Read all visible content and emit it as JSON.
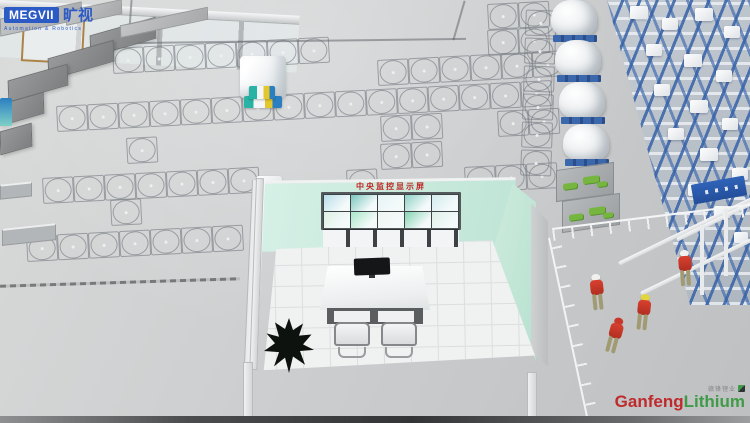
{
  "header": {
    "megvii_logo": "MEGVII",
    "megvii_cn": "旷视",
    "megvii_tagline": "Automation & Robotics"
  },
  "control_room": {
    "sign_text": "中央监控显示屏"
  },
  "footer": {
    "ganfeng_cn": "赣锋锂业",
    "ganfeng_red": "Ganfeng",
    "ganfeng_green": "Lithium"
  },
  "colors": {
    "accent_blue": "#2d5bc6",
    "rack_blue": "#3b67ad",
    "wall_mint": "#cdebdd",
    "sign_red": "#c42424",
    "ganfeng_red": "#bf2a2c",
    "ganfeng_green": "#3f9b47",
    "vest_red": "#d8402f",
    "helmet_yellow": "#e2d63c"
  },
  "scene": {
    "grid_rows": [
      {
        "x": 112,
        "y": 48,
        "n": 7
      },
      {
        "x": 487,
        "y": 4,
        "n": 2
      },
      {
        "x": 487,
        "y": 30,
        "n": 2
      },
      {
        "x": 377,
        "y": 60,
        "n": 6
      },
      {
        "x": 56,
        "y": 106,
        "n": 16
      },
      {
        "x": 380,
        "y": 116,
        "n": 2
      },
      {
        "x": 497,
        "y": 111,
        "n": 2
      },
      {
        "x": 380,
        "y": 144,
        "n": 2
      },
      {
        "x": 464,
        "y": 167,
        "n": 3
      },
      {
        "x": 126,
        "y": 138,
        "n": 1
      },
      {
        "x": 42,
        "y": 178,
        "n": 7
      },
      {
        "x": 110,
        "y": 200,
        "n": 1
      },
      {
        "x": 26,
        "y": 236,
        "n": 7
      },
      {
        "x": 346,
        "y": 170,
        "n": 1
      }
    ],
    "grid_col": {
      "x": 523,
      "y": 10,
      "n": 6
    },
    "dark_blocks": [
      {
        "x": 90,
        "y": 26,
        "w": 64,
        "h": 20
      },
      {
        "x": 48,
        "y": 49,
        "w": 64,
        "h": 20
      },
      {
        "x": 8,
        "y": 72,
        "w": 58,
        "h": 20
      },
      {
        "x": 0,
        "y": 98,
        "w": 42,
        "h": 20
      },
      {
        "x": 0,
        "y": 127,
        "w": 30,
        "h": 22
      }
    ],
    "machines": [
      {
        "x": 0,
        "y": 10,
        "w": 80,
        "h": 16
      },
      {
        "x": 66,
        "y": 5,
        "w": 54,
        "h": 13
      },
      {
        "x": 120,
        "y": 16,
        "w": 86,
        "h": 11
      }
    ],
    "left_platforms": [
      {
        "x": 0,
        "y": 183,
        "w": 30,
        "h": 12
      },
      {
        "x": 2,
        "y": 226,
        "w": 52,
        "h": 14
      }
    ],
    "bags": [
      {
        "x": 551,
        "y": 0
      },
      {
        "x": 555,
        "y": 40
      },
      {
        "x": 559,
        "y": 82
      },
      {
        "x": 563,
        "y": 124
      }
    ],
    "green_platforms": [
      {
        "x": 556,
        "y": 166
      },
      {
        "x": 562,
        "y": 197
      }
    ],
    "workers": [
      {
        "x": 589,
        "y": 274,
        "helmet": "#f0f0ee",
        "rot": -6
      },
      {
        "x": 635,
        "y": 294,
        "helmet": "#e2d63c",
        "rot": 6
      },
      {
        "x": 606,
        "y": 317,
        "helmet": "#c8372a",
        "rot": 15
      },
      {
        "x": 677,
        "y": 250,
        "helmet": "#f0f0ee",
        "rot": -4
      }
    ],
    "rack_boxes": [
      {
        "x": 630,
        "y": 6,
        "w": 18,
        "h": 13
      },
      {
        "x": 662,
        "y": 18,
        "w": 16,
        "h": 12
      },
      {
        "x": 695,
        "y": 8,
        "w": 18,
        "h": 13
      },
      {
        "x": 724,
        "y": 26,
        "w": 16,
        "h": 12
      },
      {
        "x": 646,
        "y": 44,
        "w": 16,
        "h": 12
      },
      {
        "x": 684,
        "y": 54,
        "w": 18,
        "h": 13
      },
      {
        "x": 716,
        "y": 70,
        "w": 16,
        "h": 12
      },
      {
        "x": 654,
        "y": 84,
        "w": 16,
        "h": 12
      },
      {
        "x": 690,
        "y": 100,
        "w": 18,
        "h": 13
      },
      {
        "x": 722,
        "y": 118,
        "w": 16,
        "h": 12
      },
      {
        "x": 668,
        "y": 128,
        "w": 16,
        "h": 12
      },
      {
        "x": 700,
        "y": 148,
        "w": 18,
        "h": 13
      },
      {
        "x": 732,
        "y": 168,
        "w": 16,
        "h": 12
      },
      {
        "x": 688,
        "y": 184,
        "w": 16,
        "h": 12
      },
      {
        "x": 714,
        "y": 206,
        "w": 16,
        "h": 12
      },
      {
        "x": 734,
        "y": 232,
        "w": 14,
        "h": 11
      }
    ],
    "mezz_beams": [
      {
        "x": 618,
        "y": 262,
        "w": 150,
        "rot": -26
      },
      {
        "x": 640,
        "y": 292,
        "w": 130,
        "rot": -26
      },
      {
        "x": 676,
        "y": 238,
        "w": 110,
        "rot": -26
      }
    ],
    "mezz_posts": [
      {
        "x": 700,
        "y": 225,
        "h": 70
      },
      {
        "x": 724,
        "y": 206,
        "h": 70
      }
    ],
    "video_screens": [
      "#b9dde8",
      "#79c6bd",
      "#e6f3f5",
      "#8fd2c6",
      "#d4ebee",
      "#ddf0e4",
      "#a8e8c8",
      "#eef6f1",
      "#86d4b4",
      "#def0e8"
    ]
  }
}
